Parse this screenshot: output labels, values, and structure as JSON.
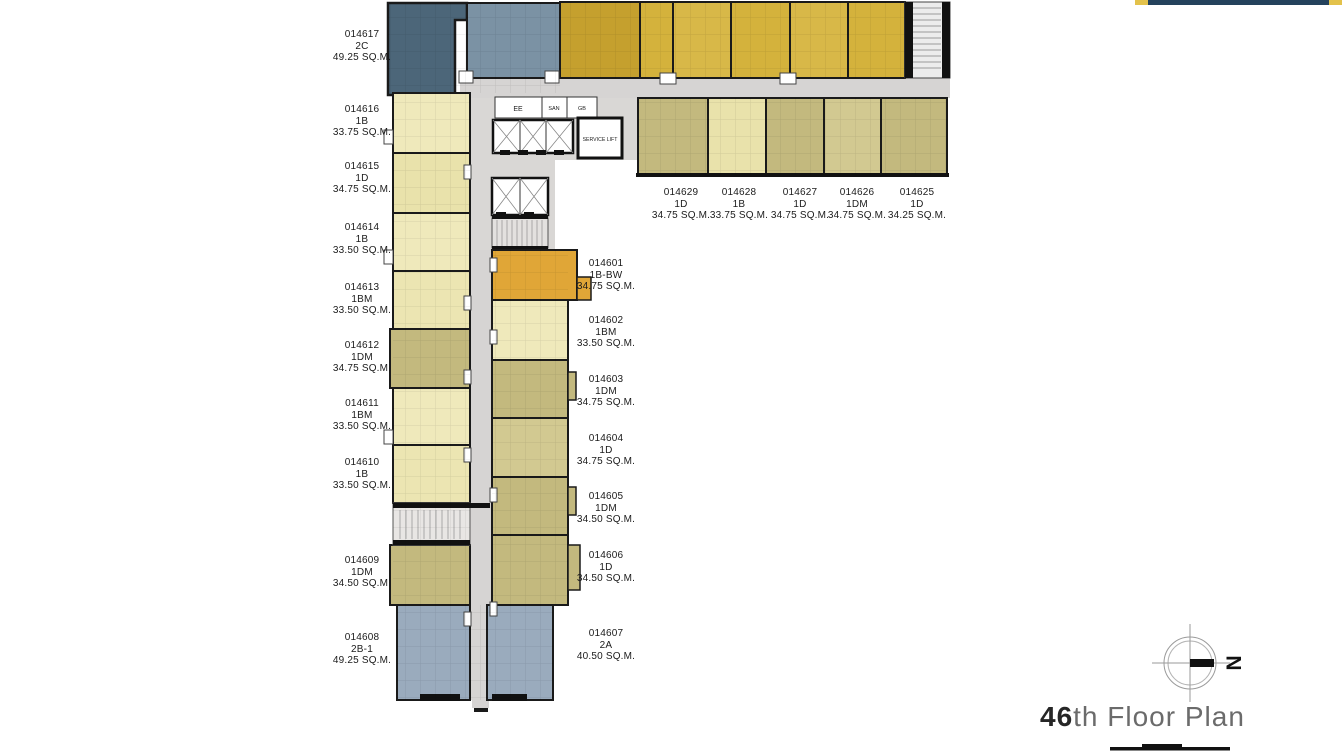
{
  "title": {
    "floor_number": "46",
    "floor_text": "th Floor Plan"
  },
  "compass": {
    "north_label": "N"
  },
  "plan": {
    "core_rooms": {
      "ee": "EE",
      "san": "SAN",
      "gb": "GB",
      "service_lift": "SERVICE LIFT"
    }
  },
  "units": {
    "left": [
      {
        "id": "014617",
        "type": "2C",
        "size": "49.25 SQ.M."
      },
      {
        "id": "014616",
        "type": "1B",
        "size": "33.75 SQ.M."
      },
      {
        "id": "014615",
        "type": "1D",
        "size": "34.75 SQ.M."
      },
      {
        "id": "014614",
        "type": "1B",
        "size": "33.50 SQ.M."
      },
      {
        "id": "014613",
        "type": "1BM",
        "size": "33.50 SQ.M."
      },
      {
        "id": "014612",
        "type": "1DM",
        "size": "34.75 SQ.M."
      },
      {
        "id": "014611",
        "type": "1BM",
        "size": "33.50 SQ.M."
      },
      {
        "id": "014610",
        "type": "1B",
        "size": "33.50 SQ.M."
      },
      {
        "id": "014609",
        "type": "1DM",
        "size": "34.50 SQ.M."
      },
      {
        "id": "014608",
        "type": "2B-1",
        "size": "49.25 SQ.M."
      }
    ],
    "middle": [
      {
        "id": "014601",
        "type": "1B-BW",
        "size": "34.75 SQ.M."
      },
      {
        "id": "014602",
        "type": "1BM",
        "size": "33.50 SQ.M."
      },
      {
        "id": "014603",
        "type": "1DM",
        "size": "34.75 SQ.M."
      },
      {
        "id": "014604",
        "type": "1D",
        "size": "34.75 SQ.M."
      },
      {
        "id": "014605",
        "type": "1DM",
        "size": "34.50 SQ.M."
      },
      {
        "id": "014606",
        "type": "1D",
        "size": "34.50 SQ.M."
      },
      {
        "id": "014607",
        "type": "2A",
        "size": "40.50 SQ.M."
      }
    ],
    "top": [
      {
        "id": "014629",
        "type": "1D",
        "size": "34.75 SQ.M."
      },
      {
        "id": "014628",
        "type": "1B",
        "size": "33.75 SQ.M."
      },
      {
        "id": "014627",
        "type": "1D",
        "size": "34.75 SQ.M."
      },
      {
        "id": "014626",
        "type": "1DM",
        "size": "34.75 SQ.M."
      },
      {
        "id": "014625",
        "type": "1D",
        "size": "34.25 SQ.M."
      }
    ]
  },
  "colors": {
    "gold": "#d4b23c",
    "gold_dark": "#c5a02e",
    "orange": "#e0a637",
    "pale_yellow": "#efe9bb",
    "pale_yellow2": "#e9e2ab",
    "olive": "#c3b97e",
    "olive_light": "#d2c991",
    "slate_blue_dark": "#4c6679",
    "slate_blue_medium": "#7b92a4",
    "slate_blue_light": "#9aabbd",
    "corridor_gray": "#d6d4d3",
    "wall": "#1a1a1a",
    "accent_navy": "#24425c",
    "accent_yellow": "#e3c24b"
  }
}
